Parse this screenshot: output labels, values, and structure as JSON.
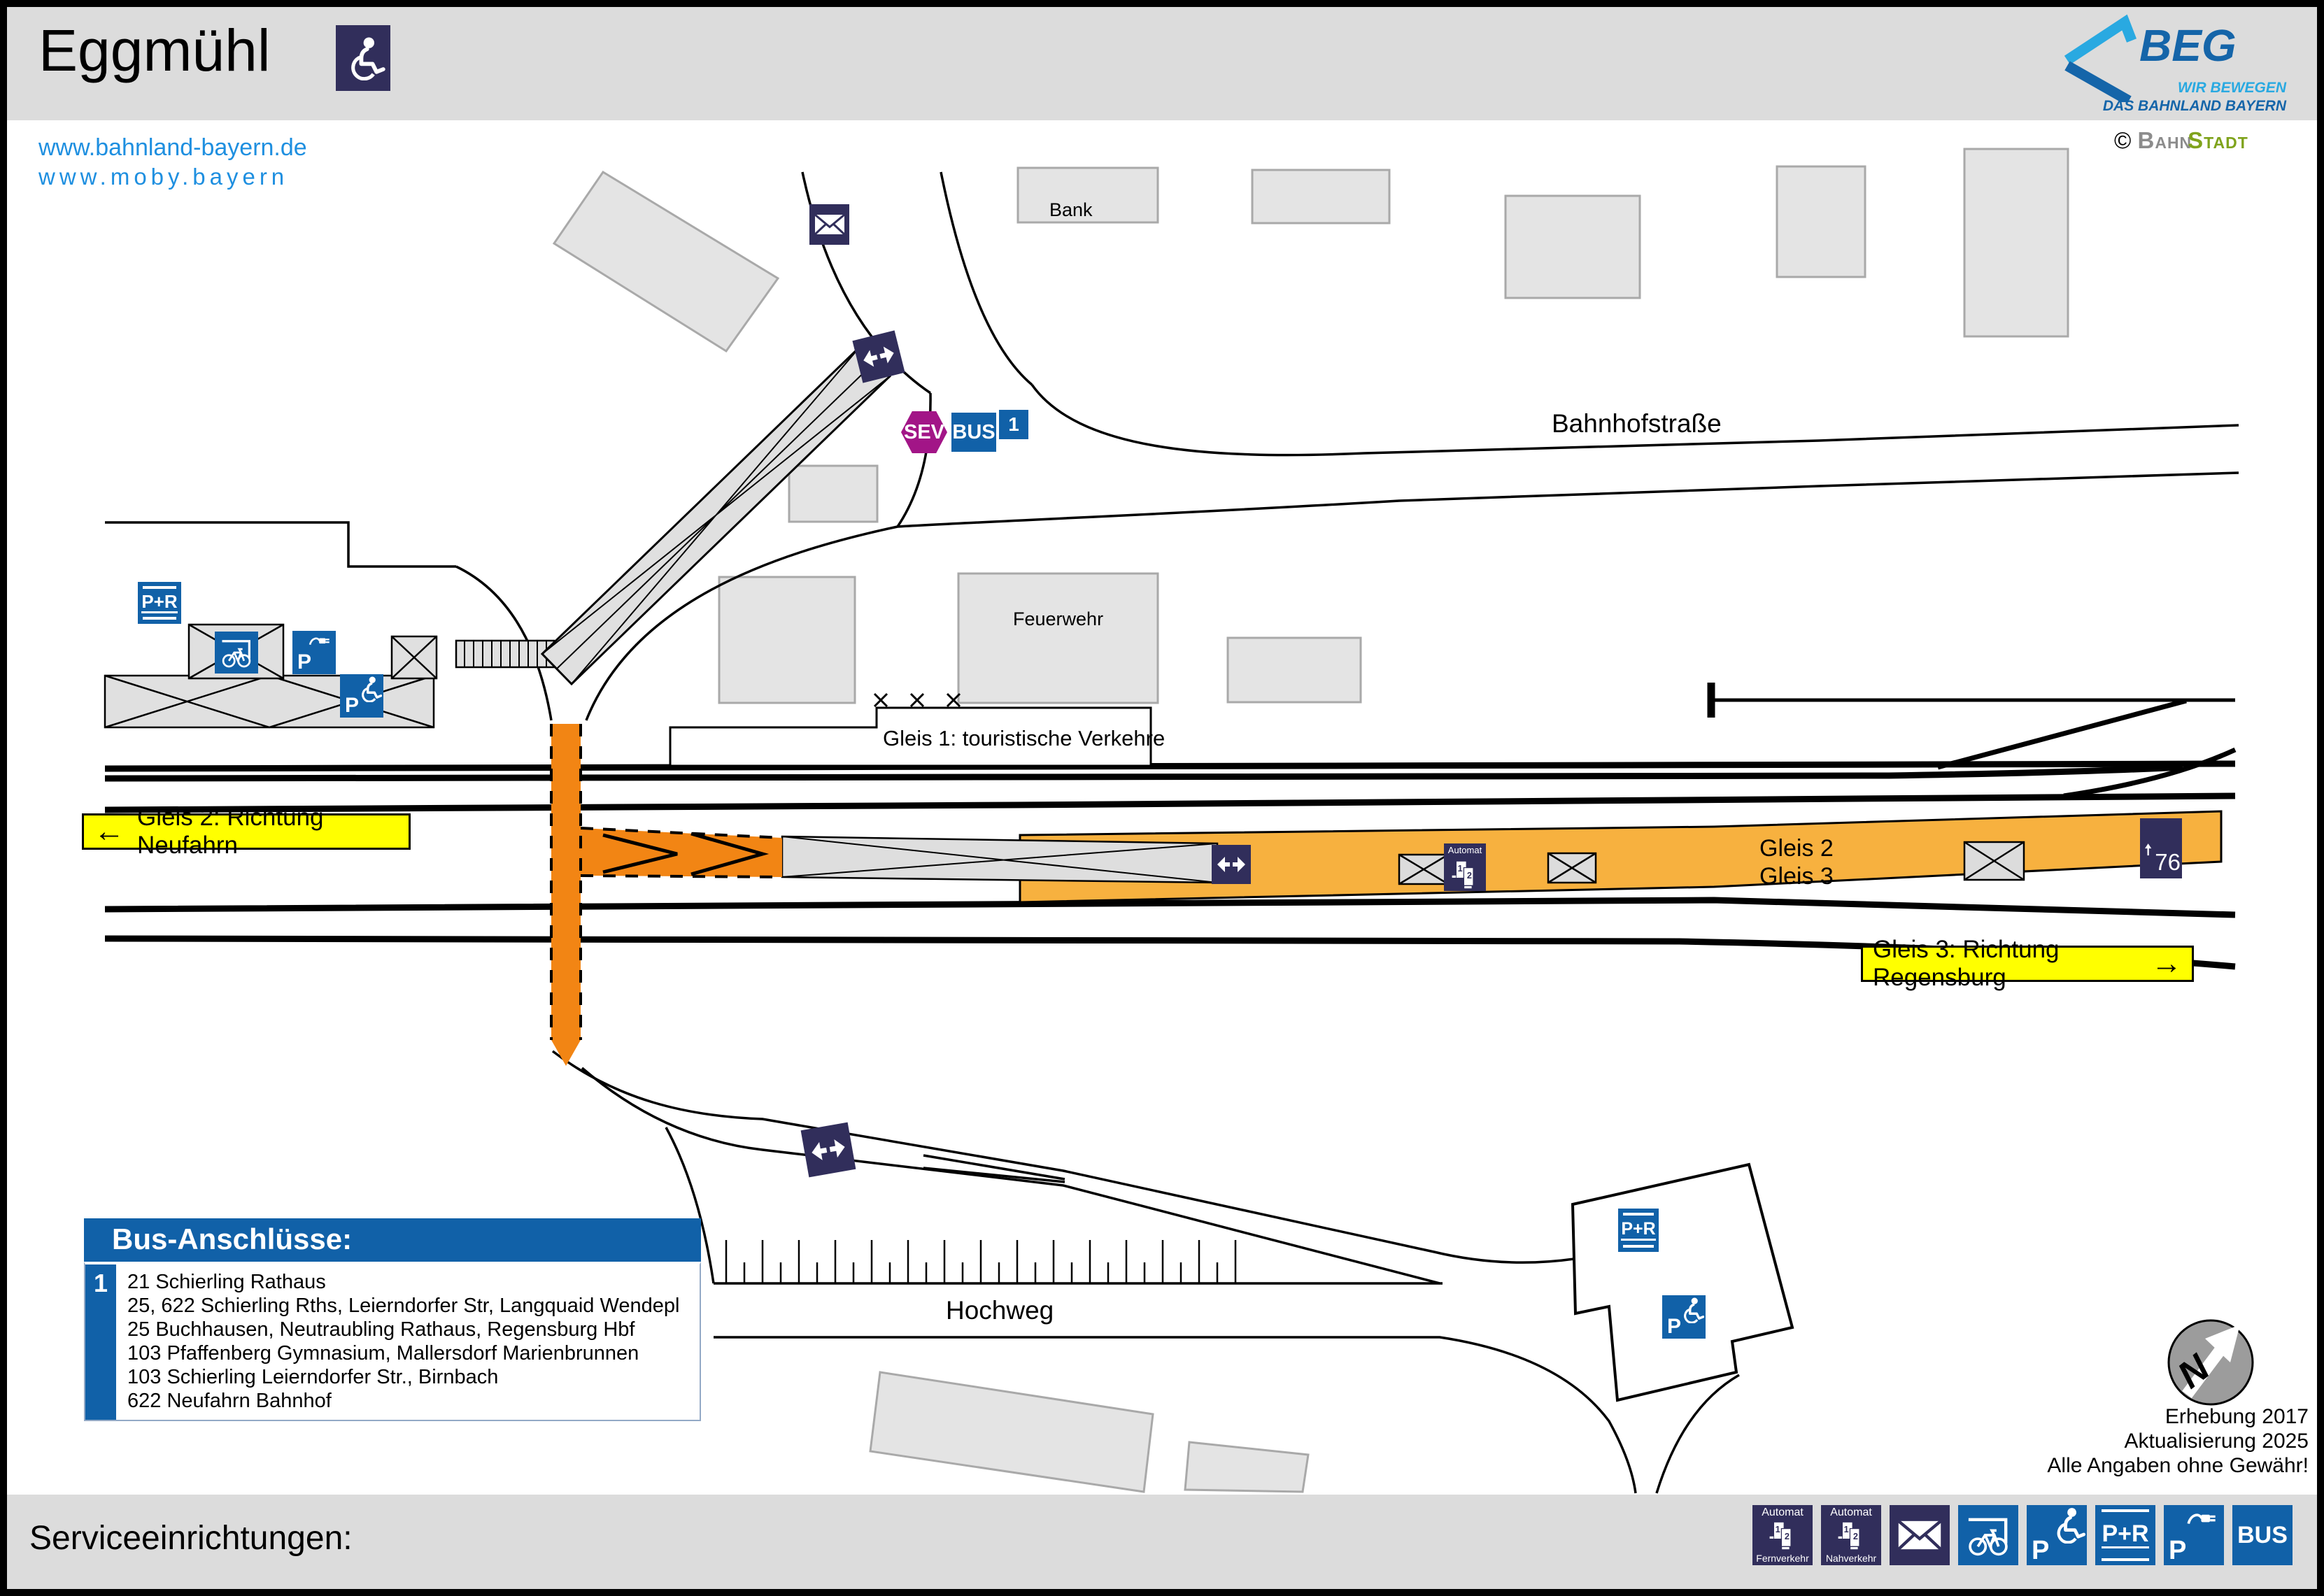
{
  "header": {
    "station_name": "Eggmühl",
    "website1": "www.bahnland-bayern.de",
    "website2": "www.moby.bayern",
    "beg_logo": {
      "text": "BEG",
      "tagline_line1": "WIR BEWEGEN",
      "tagline_line2": "DAS BAHNLAND BAYERN"
    },
    "credit": {
      "copyright": "©",
      "brand_gray": "Bahn",
      "brand_green": "Stadt"
    }
  },
  "map": {
    "streets": {
      "bahnhofstrasse": "Bahnhofstraße",
      "hochweg": "Hochweg"
    },
    "buildings": {
      "bank": "Bank",
      "feuerwehr": "Feuerwehr"
    },
    "gleis1_note": "Gleis 1: touristische Verkehre",
    "direction_left": {
      "arrow": "←",
      "label": "Gleis 2: Richtung Neufahrn"
    },
    "direction_right": {
      "label": "Gleis 3: Richtung Regensburg",
      "arrow": "→"
    },
    "platform_labels": {
      "gleis2": "Gleis 2",
      "gleis3": "Gleis 3"
    },
    "platform_height": "76",
    "automat": "Automat",
    "sev": "SEV",
    "bus": "BUS",
    "bus_stop_number": "1",
    "park_ride": "P+R",
    "parking_p": "P",
    "compass_n": "N"
  },
  "bus_connections": {
    "title": "Bus-Anschlüsse:",
    "stop_number": "1",
    "lines": [
      "21 Schierling Rathaus",
      "25, 622 Schierling Rths, Leierndorfer Str, Langquaid Wendepl",
      "25 Buchhausen, Neutraubling Rathaus, Regensburg Hbf",
      "103 Pfaffenberg Gymnasium, Mallersdorf Marienbrunnen",
      "103 Schierling Leierndorfer Str., Birnbach",
      "622 Neufahrn Bahnhof"
    ]
  },
  "notes": {
    "line1": "Erhebung 2017",
    "line2": "Aktualisierung 2025",
    "line3": "Alle Angaben ohne Gewähr!"
  },
  "footer": {
    "title": "Serviceeinrichtungen:",
    "automat_top": "Automat",
    "fernverkehr": "Fernverkehr",
    "nahverkehr": "Nahverkehr",
    "park_ride": "P+R",
    "parking_p": "P",
    "bus": "BUS"
  },
  "icons": {
    "machine_digit1": "1",
    "machine_digit2": "2"
  },
  "colors": {
    "accent_blue": "#1161A8",
    "navy": "#312E5B",
    "platform_orange": "#F7B13F",
    "crossing_orange": "#F28514",
    "highlight_yellow": "#FFFF00",
    "sev_magenta": "#A21587",
    "link_blue": "#1E8FE0",
    "beg_dark_blue": "#1565A9",
    "beg_light_blue": "#29A9E1",
    "bahnstadt_green": "#7FA31C"
  }
}
